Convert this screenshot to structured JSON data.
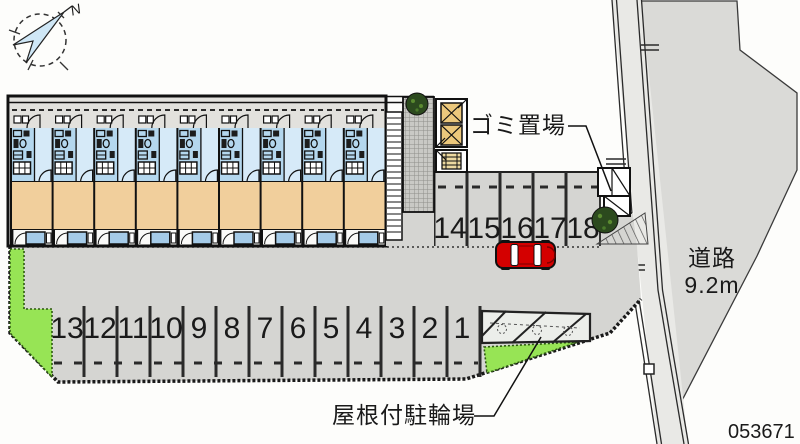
{
  "compass": {
    "north_label": "N"
  },
  "labels": {
    "garbage_area": "ゴミ置場",
    "road_name": "道路",
    "road_width": "9.2m",
    "covered_bicycle_parking": "屋根付駐輪場",
    "plan_number": "053671"
  },
  "parking": {
    "bottom_row": [
      "13",
      "12",
      "11",
      "10",
      "9",
      "8",
      "7",
      "6",
      "5",
      "4",
      "3",
      "2",
      "1"
    ],
    "middle_row": [
      "14",
      "15",
      "16",
      "17",
      "18"
    ]
  },
  "colors": {
    "site_gray": "#d5d5d2",
    "corridor_gray": "#e2e1dd",
    "room_tan": "#f1cf9c",
    "unit_blue": "#b4d7ee",
    "unit_blue_light": "#d6eaf8",
    "balcony_blue": "#a5cbe8",
    "greenery": "#97e455",
    "car_red": "#d40000",
    "storage_yellow": "#ecc87c",
    "road_gray": "#e9e9e6",
    "sidewalk_gray": "#dadad7",
    "compass_blue": "#cfe7f6"
  }
}
